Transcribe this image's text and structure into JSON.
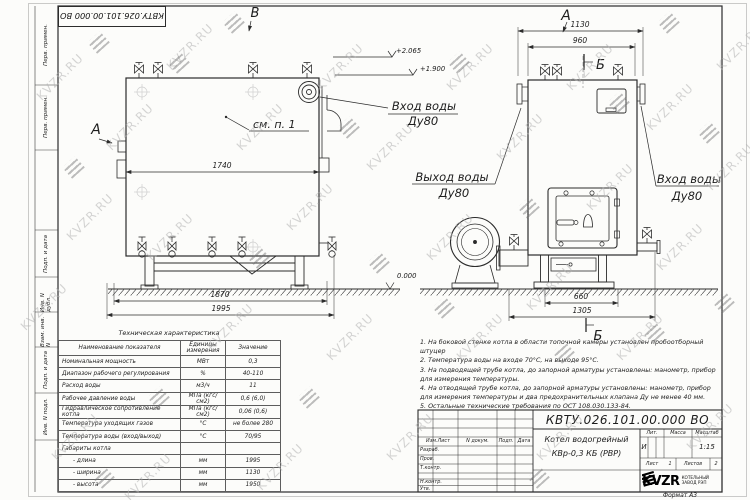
{
  "sheet": {
    "watermark_text": "KVZR.RU",
    "top_stamp": "КВТУ.026.101.00.000  ВО",
    "margin_labels": [
      "Перв. примен.",
      "Перв. примен.",
      "Подп. и дата",
      "Инв. N дубл.",
      "Взам. инв. N",
      "Подп. и дата",
      "Инв. N подл."
    ]
  },
  "drawing": {
    "side_view": {
      "view_arrow_a": "А",
      "view_arrow_b": "В",
      "callout_see_note": "см. п. 1",
      "dim_body": "1740",
      "dim_frame": "1870",
      "dim_overall": "1995",
      "elev_top": "+2.065",
      "elev_mid": "+1.900",
      "elev_ground": "0.000",
      "inlet_label_1": "Вход воды",
      "inlet_label_2": "Ду80",
      "outlet_label_1": "Выход воды",
      "outlet_label_2": "Ду80"
    },
    "front_view": {
      "view_arrow_a": "А",
      "section_mark": "Б",
      "dim_overall_width": "1130",
      "dim_body_width": "960",
      "dim_base": "660",
      "dim_full": "1305",
      "inlet_label_1": "Вход воды",
      "inlet_label_2": "Ду80"
    }
  },
  "spec_table": {
    "title": "Техническая характеристика",
    "headers": [
      "Наименование показателя",
      "Единицы измерения",
      "Значение"
    ],
    "rows": [
      [
        "Номинальная мощность",
        "МВт",
        "0,3"
      ],
      [
        "Диапазон рабочего регулирования",
        "%",
        "40-110"
      ],
      [
        "Расход воды",
        "м3/ч",
        "11"
      ],
      [
        "Рабочее давление воды",
        "МПа (кгс/см2)",
        "0,6 (6,0)"
      ],
      [
        "Гидравлическое сопротивление котла",
        "МПа (кгс/см2)",
        "0,06 (0,6)"
      ],
      [
        "Температура уходящих газов",
        "°С",
        "не более 280"
      ],
      [
        "Температура воды (вход/выход)",
        "°С",
        "70/95"
      ],
      [
        "Габариты котла",
        "",
        ""
      ],
      [
        "- длина",
        "мм",
        "1995"
      ],
      [
        "- ширина",
        "мм",
        "1130"
      ],
      [
        "- высота",
        "мм",
        "1950"
      ]
    ]
  },
  "notes": [
    "1. На боковой стенке котла в области топочной камеры установлен пробоотборный штуцер",
    "2. Температура воды на входе 70°С, на выходе 95°С.",
    "3. На подводящей трубе котла, до запорной арматуры установлены: манометр, прибор для измерения температуры.",
    "4. На отводящей трубе котла, до запорной арматуры установлены: манометр, прибор для измерения температуры и два предохранительных клапана Ду не менее 40 мм.",
    "5. Остальные технические требования по ОСТ 108.030.133-84."
  ],
  "title_block": {
    "doc_number": "КВТУ.026.101.00.000  ВО",
    "product_line1": "Котел водогрейный",
    "product_line2": "КВр-0,3 КБ (РВР)",
    "header_row": [
      "Изм.Лист",
      "N докум.",
      "Подп.",
      "Дата"
    ],
    "left_rows": [
      "Разраб.",
      "Пров.",
      "Т.контр.",
      "Н.контр.",
      "Утв."
    ],
    "lit_label": "Лит.",
    "lit_value": "И",
    "mass_label": "Масса",
    "scale_label": "Масштаб",
    "scale_value": "1:15",
    "sheet_label": "Лист",
    "sheet_value": "1",
    "sheets_label": "Листов",
    "sheets_value": "2",
    "logo_text": "KVZR",
    "logo_sub1": "КОТЕЛЬНЫЙ",
    "logo_sub2": "ЗАВОД РЭП",
    "format_label": "Формат  А3"
  }
}
